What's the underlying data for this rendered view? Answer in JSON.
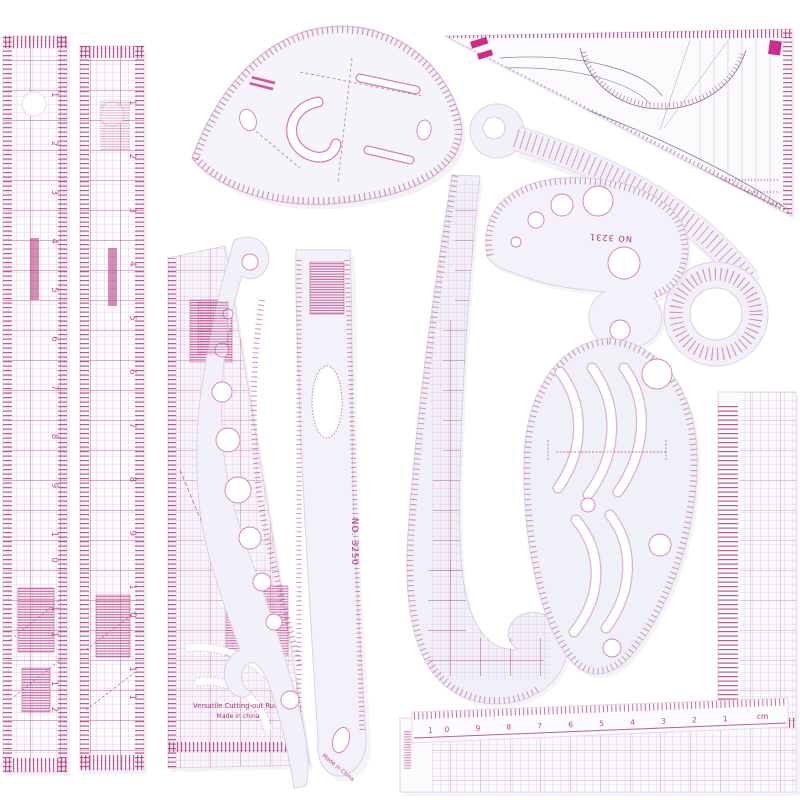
{
  "photo": {
    "subject": "Sewing tailor pattern-making ruler set, clear plastic with pink printed scales",
    "background": "#ffffff"
  },
  "palette": {
    "plastic": "#f4f3fa",
    "plastic_cool": "#eef0f8",
    "plastic_edge": "#d9cfe5",
    "print_pink": "#b43080",
    "print_light": "#dd9ec6",
    "ink_gray": "#7a7f8c",
    "stamp_magenta": "#cd2b87",
    "shadow": "#9aa0c0"
  },
  "labels": {
    "french_curve_model": "NO 3231",
    "straight_curve_model": "NO. 3250",
    "grading_ruler_line1": "Versatile Cutting-out Ruler",
    "grading_ruler_line2": "Made in china",
    "origin_mark": "Made in China",
    "unit": "cm"
  },
  "scales": {
    "patchwork_left": [
      "1",
      "2",
      "3",
      "4",
      "5",
      "6",
      "7",
      "8",
      "9",
      "10",
      "11",
      "12"
    ],
    "patchwork_right": [
      "1",
      "2",
      "3",
      "4",
      "5",
      "6",
      "7",
      "8",
      "9",
      "10",
      "11"
    ],
    "cm_ruler": [
      "10",
      "9",
      "8",
      "7",
      "6",
      "5",
      "4",
      "3",
      "2",
      "1"
    ]
  },
  "items": [
    {
      "name": "patchwork-ruler-left",
      "kind": "straight quilting ruler with grid and size tables"
    },
    {
      "name": "patchwork-ruler-right",
      "kind": "straight quilting ruler with grid and size tables"
    },
    {
      "name": "teardrop-curve-template",
      "kind": "large teardrop tailor curve with inner cutouts"
    },
    {
      "name": "tailor-set-square",
      "kind": "right-triangle set square with curve guides and protractor arc"
    },
    {
      "name": "sleeve-curve-ruler",
      "kind": "long curved stick ruler with hook hole and ring end"
    },
    {
      "name": "french-curve-3231",
      "kind": "comma-shaped french curve, model NO 3231"
    },
    {
      "name": "grading-ruler",
      "kind": "versatile cutting-out ruler with grid, tables and corner arcs"
    },
    {
      "name": "straight-curve-3250",
      "kind": "gently curved ruler, model NO. 3250, oval cutout"
    },
    {
      "name": "graduated-hole-curve",
      "kind": "long french curve with graduated circle holes"
    },
    {
      "name": "hip-curve-grid-ruler",
      "kind": "long J-shaped hip curve with grid columns"
    },
    {
      "name": "armhole-template",
      "kind": "egg-shaped armhole template with S-slots and holes"
    },
    {
      "name": "l-square-ruler",
      "kind": "L-square with fine grid, vertical and horizontal arms"
    },
    {
      "name": "cm-ruler",
      "kind": "narrow straight centimetre ruler"
    }
  ]
}
